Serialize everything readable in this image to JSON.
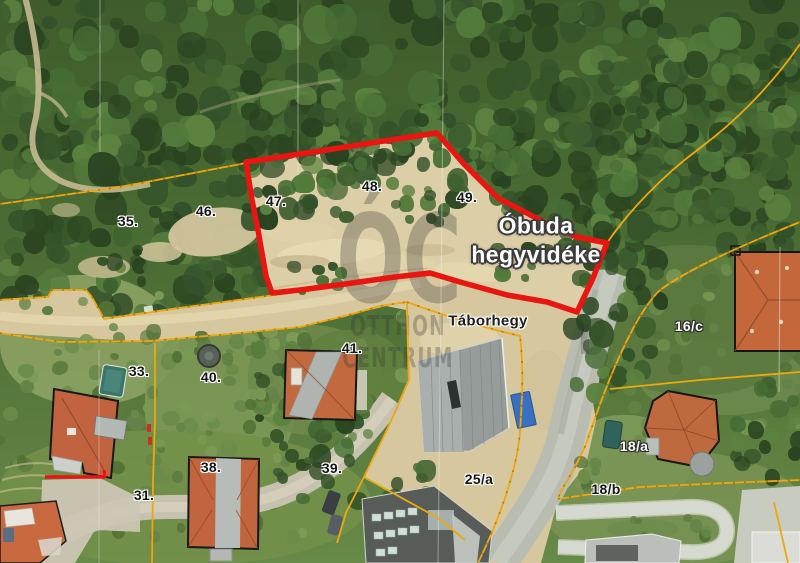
{
  "overlay_text": {
    "region_line1": "Óbuda",
    "region_line2": "hegyvidéke",
    "street": "Táborhegy"
  },
  "watermark": {
    "monogram": "ÓC",
    "word1": "OTTHON",
    "word2": "CENTRUM"
  },
  "parcel_labels": [
    {
      "text": "35.",
      "x": 128,
      "y": 221,
      "tone": "dark"
    },
    {
      "text": "46.",
      "x": 206,
      "y": 211,
      "tone": "dark"
    },
    {
      "text": "47.",
      "x": 276,
      "y": 201,
      "tone": "dark"
    },
    {
      "text": "48.",
      "x": 372,
      "y": 186,
      "tone": "dark"
    },
    {
      "text": "49.",
      "x": 467,
      "y": 197,
      "tone": "dark"
    },
    {
      "text": "41.",
      "x": 352,
      "y": 348,
      "tone": "dark"
    },
    {
      "text": "33.",
      "x": 139,
      "y": 371,
      "tone": "dark"
    },
    {
      "text": "40.",
      "x": 211,
      "y": 377,
      "tone": "dark"
    },
    {
      "text": "38.",
      "x": 211,
      "y": 467,
      "tone": "dark"
    },
    {
      "text": "31.",
      "x": 144,
      "y": 495,
      "tone": "dark"
    },
    {
      "text": "39.",
      "x": 332,
      "y": 468,
      "tone": "dark"
    },
    {
      "text": "25/a",
      "x": 479,
      "y": 479,
      "tone": "dark"
    },
    {
      "text": "16/c",
      "x": 689,
      "y": 326,
      "tone": "light"
    },
    {
      "text": "18/a",
      "x": 634,
      "y": 446,
      "tone": "light"
    },
    {
      "text": "18/b",
      "x": 606,
      "y": 489,
      "tone": "dark"
    }
  ],
  "colors": {
    "highlight_outline": "#e91511",
    "cadastral_line": "#eda80e",
    "dirt": "#d7c79e",
    "forest": "#3e5c2d"
  }
}
